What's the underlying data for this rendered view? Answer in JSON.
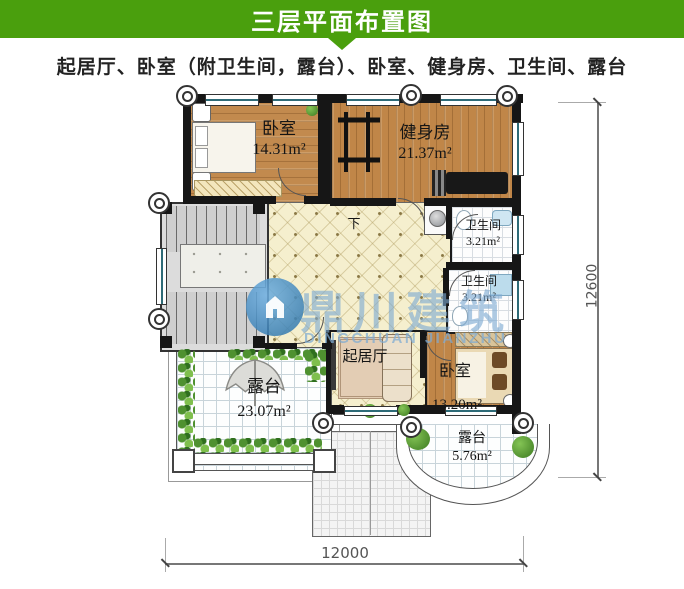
{
  "header": {
    "title": "三层平面布置图"
  },
  "subtitle": "起居厅、卧室（附卫生间，露台）、卧室、健身房、卫生间、露台",
  "rooms": {
    "bedroom_top": {
      "name": "卧室",
      "area": "14.31m²"
    },
    "gym": {
      "name": "健身房",
      "area": "21.37m²"
    },
    "bath_upper": {
      "name": "卫生间",
      "area": "3.21m²"
    },
    "bath_lower": {
      "name": "卫生间",
      "area": "3.21m²"
    },
    "living": {
      "name": "起居厅"
    },
    "bedroom_bottom": {
      "name": "卧室",
      "area": "13.20m²"
    },
    "terrace_large": {
      "name": "露台",
      "area": "23.07m²"
    },
    "terrace_small": {
      "name": "露台",
      "area": "5.76m²"
    },
    "stair_down_label": "下"
  },
  "dimensions": {
    "bottom_width": "12000",
    "right_height": "12600"
  },
  "watermark": {
    "name_cn": "鼎川建筑",
    "name_en": "DINGCHUAN JIANZHU"
  },
  "colors": {
    "header_green": "#4a9f0d",
    "wall": "#161616",
    "wood": "#c28a4e",
    "hall_cream": "#f5efce",
    "watermark_blue": "#7fb0d8"
  }
}
